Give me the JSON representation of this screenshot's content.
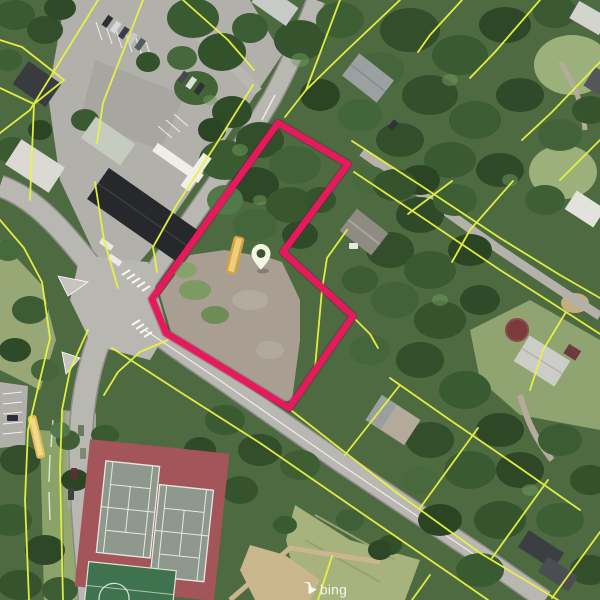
{
  "map": {
    "type": "aerial-imagery",
    "watermark": {
      "brand": "bing"
    },
    "overlay": {
      "parcel_line_color": "#e9f442",
      "selected_parcel": {
        "outline_color": "#e6195c",
        "points": "278,123 348,164 283,252 353,316 289,408 166,333 152,299"
      },
      "marker": {
        "transform": "translate(261,270)",
        "fill": "#f2f7e2",
        "hole_fill": "#42503a"
      }
    }
  }
}
